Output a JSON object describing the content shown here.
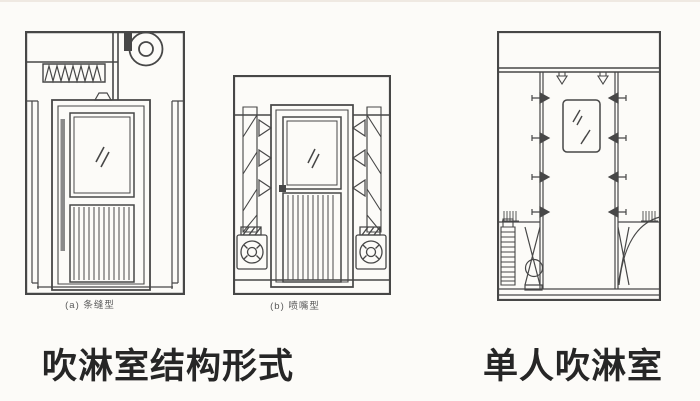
{
  "page": {
    "background": "#fcfbf8",
    "ink": "#474747",
    "caption_color": "#262626"
  },
  "left_figure": {
    "caption": "吹淋室结构形式",
    "diagram_a_label": "(a) 条缝型",
    "diagram_b_label": "(b) 喷嘴型"
  },
  "right_figure": {
    "caption": "单人吹淋室"
  }
}
